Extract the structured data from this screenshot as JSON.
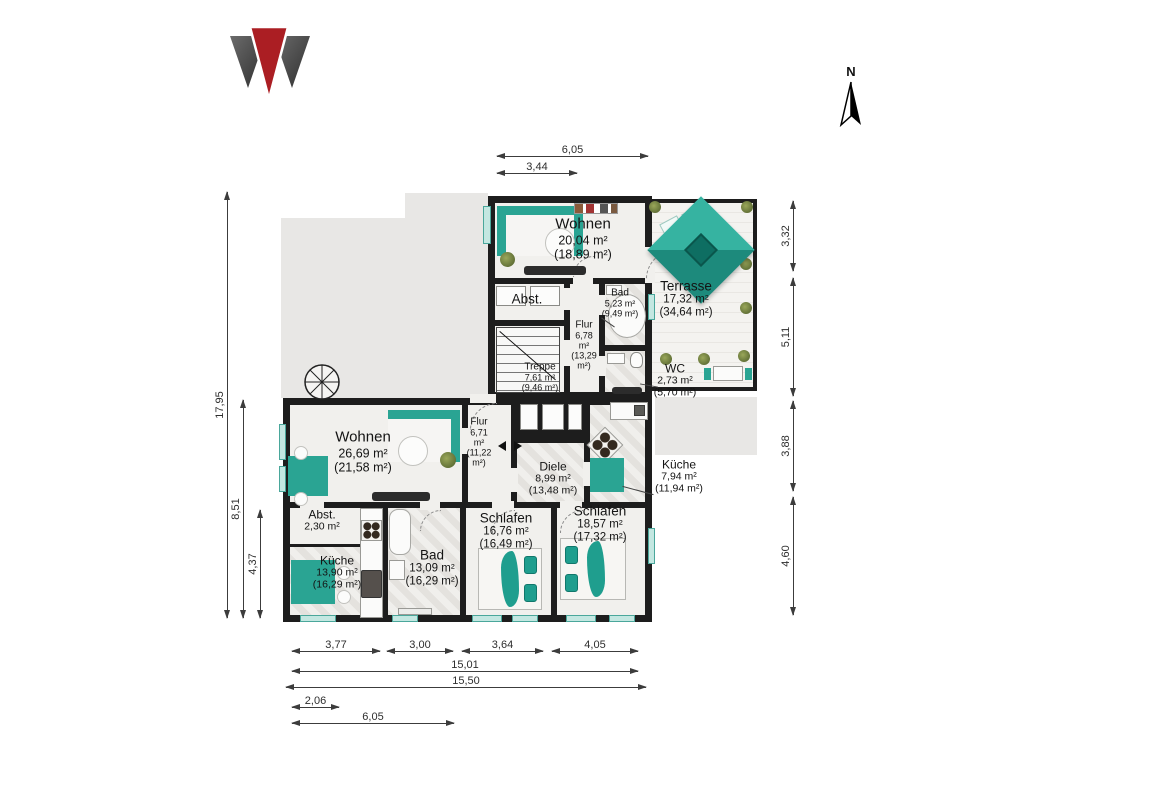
{
  "document": {
    "type": "floorplan",
    "language": "de"
  },
  "branding": {
    "logo_icon": "w-triangle-logo",
    "logo_colors": {
      "dark": "#3c3c3c",
      "red": "#ab1e23"
    }
  },
  "compass": {
    "icon": "north-arrow",
    "label": "N"
  },
  "colors": {
    "accent_teal": "#2aa493",
    "wall": "#1d1d1d",
    "floor": "#f1f0ed",
    "silhouette_gray": "#e8e7e5",
    "window_teal": "#c3e7e1"
  },
  "rooms": {
    "upper": [
      {
        "name": "Wohnen",
        "area": "20,04 m²",
        "area_alt": "(18,89 m²)"
      },
      {
        "name": "Terrasse",
        "area": "17,32 m²",
        "area_alt": "(34,64 m²)"
      },
      {
        "name": "Abst.",
        "area": "",
        "area_alt": ""
      },
      {
        "name": "Bad",
        "area": "5,23 m²",
        "area_alt": "(9,49 m²)"
      },
      {
        "name": "Flur",
        "area": "6,78\nm²",
        "area_alt": "(13,29\nm²)"
      },
      {
        "name": "Treppe",
        "area": "7,61 m²",
        "area_alt": "(9,46 m²)"
      },
      {
        "name": "WC",
        "area": "2,73 m²",
        "area_alt": "(5,70 m²)"
      }
    ],
    "lower": [
      {
        "name": "Wohnen",
        "area": "26,69 m²",
        "area_alt": "(21,58 m²)"
      },
      {
        "name": "Flur",
        "area": "6,71\nm²",
        "area_alt": "(11,22\nm²)"
      },
      {
        "name": "Diele",
        "area": "8,99 m²",
        "area_alt": "(13,48 m²)"
      },
      {
        "name": "Küche",
        "area": "7,94 m²",
        "area_alt": "(11,94 m²)"
      },
      {
        "name": "Abst.",
        "area": "2,30 m²",
        "area_alt": ""
      },
      {
        "name": "Küche",
        "area": "13,90 m²",
        "area_alt": "(16,29 m²)"
      },
      {
        "name": "Bad",
        "area": "13,09 m²",
        "area_alt": "(16,29 m²)"
      },
      {
        "name": "Schlafen",
        "area": "16,76 m²",
        "area_alt": "(16,49 m²)"
      },
      {
        "name": "Schlafen",
        "area": "18,57 m²",
        "area_alt": "(17,32 m²)"
      }
    ]
  },
  "dimensions": {
    "unit": "m",
    "top": [
      "6,05",
      "3,44"
    ],
    "left": [
      "17,95",
      "8,51",
      "4,37"
    ],
    "right": [
      "3,32",
      "5,11",
      "3,88",
      "4,60"
    ],
    "bottom": [
      "3,77",
      "3,00",
      "3,64",
      "4,05",
      "15,01",
      "15,50",
      "2,06",
      "6,05"
    ]
  }
}
